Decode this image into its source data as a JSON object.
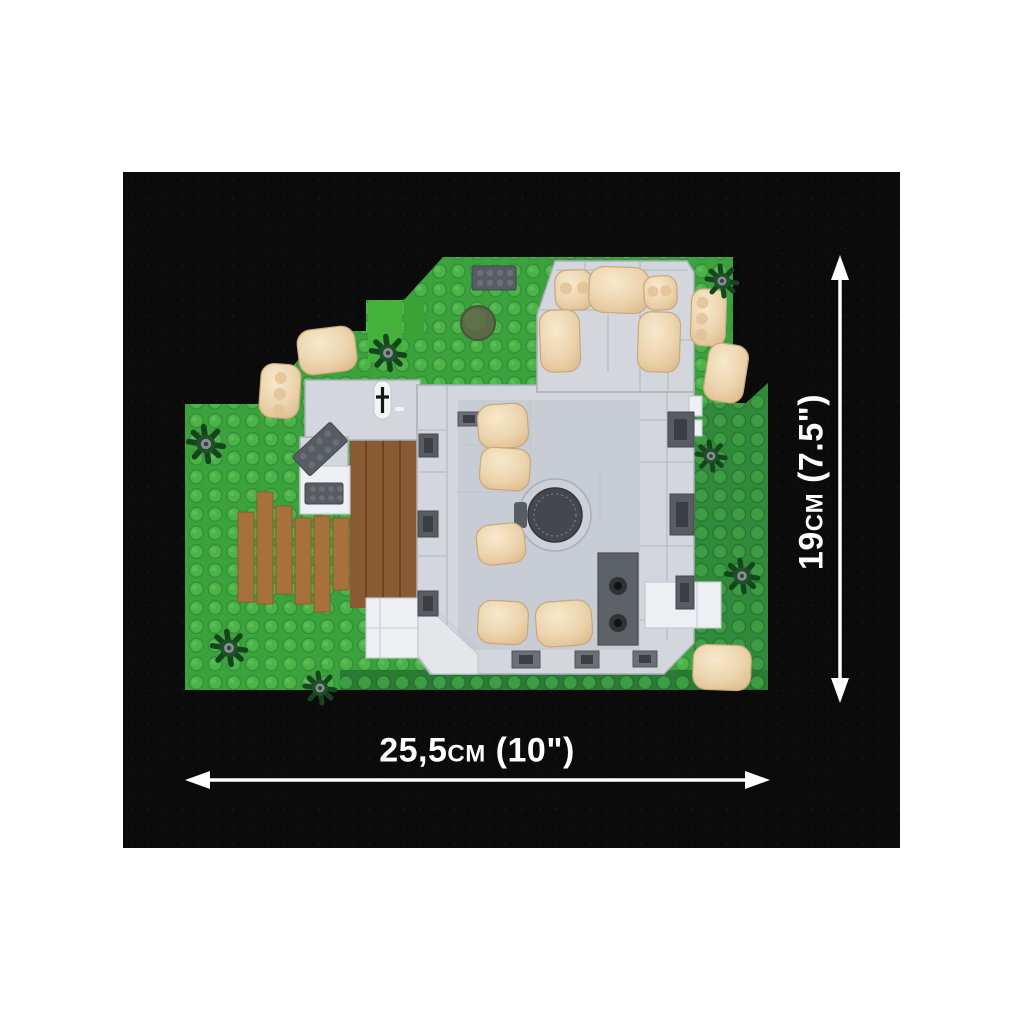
{
  "image": {
    "description": "Top-down product photo of a COBI toy brick building set on green baseplates, shown on a dark textured backdrop with white dimension arrows",
    "background_color": "#ffffff",
    "backdrop_color": "#0b0b0c"
  },
  "dimensions": {
    "width_label": "25,5cm (10\")",
    "height_label": "19cm (7.5\")",
    "arrow_color": "#ffffff"
  },
  "model": {
    "colors": {
      "baseplate_bright": "#3aa33e",
      "stud_bright": "#4ab447",
      "baseplate_dark": "#2f8a39",
      "stud_dark": "#3c9d44",
      "baseplate_strip": "#2a7b33",
      "accent_green_light": "#43b13a",
      "accent_green_mid": "#3aa335",
      "tree_green": "#17431f",
      "building_gray": "#d3d7dd",
      "building_border": "#a9afb8",
      "courtyard_gray": "#c8cdd5",
      "white_piece": "#edeff2",
      "dark_gray_brick": "#585d63",
      "deck_brown": "#a8713c",
      "floor_brown": "#8a5a32",
      "pillow_tan": "#ecd4ae",
      "pillow_highlight": "#f7e9cc",
      "pillow_shadow": "#dcb98b",
      "cylinder_olive": "#5a6a46",
      "hatch_dark": "#44474b"
    }
  }
}
